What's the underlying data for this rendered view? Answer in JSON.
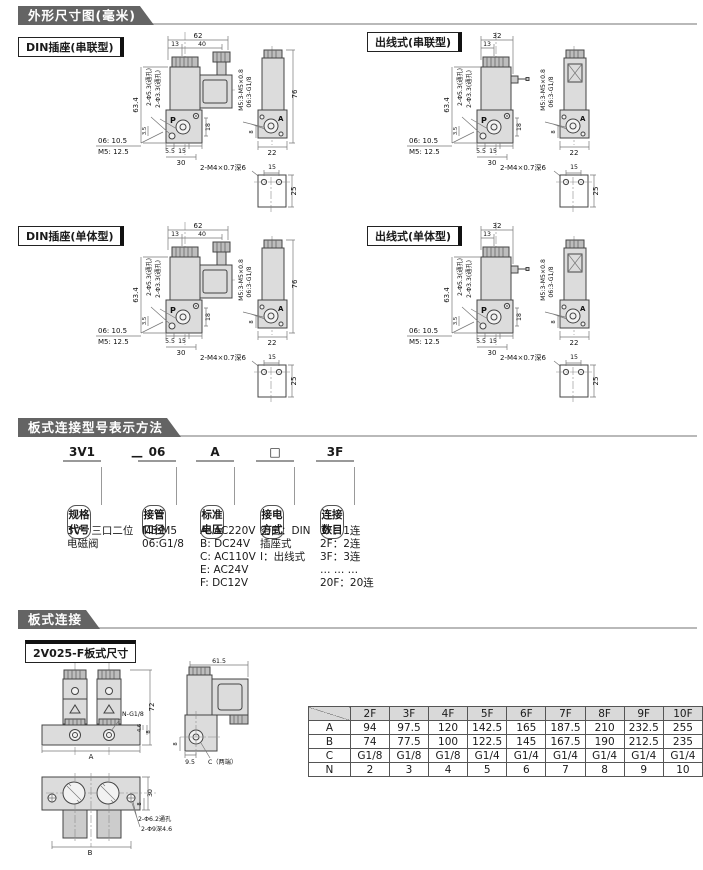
{
  "colors": {
    "banner_bg": "#646464",
    "banner_text": "#ffffff",
    "drawing_fill": "#dcdcdc",
    "table_header_bg": "#d9d9d9",
    "rule": "#b9b9b9"
  },
  "sections": {
    "dims_header": "外形尺寸图(毫米)",
    "model_header": "板式连接型号表示方法",
    "plate_header": "板式连接"
  },
  "blocks": {
    "din_series": "DIN插座(串联型)",
    "wire_series": "出线式(串联型)",
    "din_single": "DIN插座(单体型)",
    "wire_single": "出线式(单体型)"
  },
  "dims": {
    "w62": "62",
    "w13": "13",
    "w40": "40",
    "w32": "32",
    "h634": "63.4",
    "hole53": "2-Φ5.3(通孔)",
    "hole33": "2-Φ3.3(通孔)",
    "port_p": "P",
    "port_a": "A",
    "d35": "3.5",
    "d18": "18",
    "note06": "06: 10.5",
    "noteM5": "M5: 12.5",
    "d55": "5.5",
    "d15": "15",
    "d30": "30",
    "side_m5": "M5:3-M5×0.8",
    "side_06": "06:3-G1/8",
    "h76": "76",
    "d8": "8",
    "d22": "22",
    "mount_note": "2-M4×0.7深6",
    "m15": "15",
    "m25": "25"
  },
  "breakdown": {
    "dash": "—",
    "groups": [
      {
        "code": "3V1",
        "box": "规格代号",
        "lines": [
          "3V：三口二位",
          "电磁阀"
        ]
      },
      {
        "code": "06",
        "box": "接管口径",
        "lines": [
          "M5:M5",
          "06:G1/8"
        ]
      },
      {
        "code": "A",
        "box": "标准电压",
        "lines": [
          "A: AC220V",
          "B: DC24V",
          "C: AC110V",
          "E: AC24V",
          "F: DC12V"
        ]
      },
      {
        "code": "□",
        "box": "接电方式",
        "lines": [
          "空白：DIN",
          "插座式",
          "I：出线式"
        ]
      },
      {
        "code": "3F",
        "box": "连接数目",
        "lines": [
          "1F：1连",
          "2F：2连",
          "3F：3连",
          "… … …",
          "20F：20连"
        ]
      }
    ]
  },
  "plate": {
    "label": "2V025-F板式尺寸",
    "n_g18": "N-G1/8",
    "h72": "72",
    "dim_a": "A",
    "d46": "4.6",
    "d8": "8",
    "w615": "61.5",
    "d95": "9.5",
    "c_ends": "C（两端）",
    "hole62": "2-Φ6.2通孔",
    "hole9": "2-Φ9深4.6",
    "d30": "30",
    "dim_b": "B"
  },
  "table": {
    "columns": [
      "2F",
      "3F",
      "4F",
      "5F",
      "6F",
      "7F",
      "8F",
      "9F",
      "10F"
    ],
    "rows": [
      {
        "label": "A",
        "values": [
          "94",
          "97.5",
          "120",
          "142.5",
          "165",
          "187.5",
          "210",
          "232.5",
          "255"
        ]
      },
      {
        "label": "B",
        "values": [
          "74",
          "77.5",
          "100",
          "122.5",
          "145",
          "167.5",
          "190",
          "212.5",
          "235"
        ]
      },
      {
        "label": "C",
        "values": [
          "G1/8",
          "G1/8",
          "G1/8",
          "G1/4",
          "G1/4",
          "G1/4",
          "G1/4",
          "G1/4",
          "G1/4"
        ]
      },
      {
        "label": "N",
        "values": [
          "2",
          "3",
          "4",
          "5",
          "6",
          "7",
          "8",
          "9",
          "10"
        ]
      }
    ]
  }
}
